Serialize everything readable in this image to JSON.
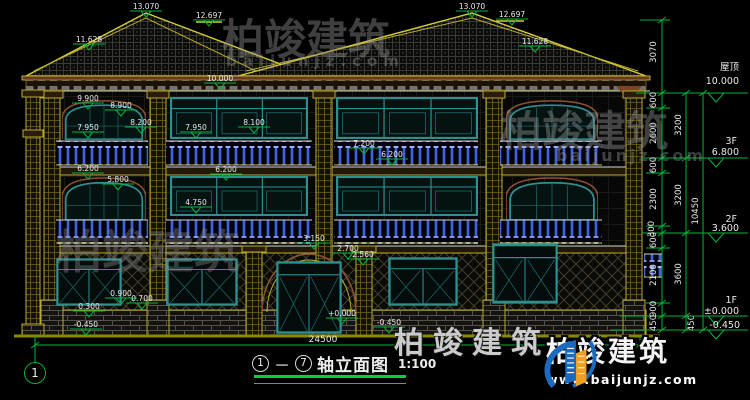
{
  "drawing": {
    "title": {
      "axis_start": "1",
      "axis_end": "7",
      "name": "轴立面图",
      "scale": "1:100"
    },
    "axis_bubble": "1",
    "total_width": "24500"
  },
  "markers": [
    {
      "label": "13.070"
    },
    {
      "label": "12.697"
    },
    {
      "label": "11.628"
    },
    {
      "label": "10.000"
    },
    {
      "label": "13.070"
    },
    {
      "label": "12.697"
    },
    {
      "label": "11.628"
    },
    {
      "label": "9.900"
    },
    {
      "label": "8.900"
    },
    {
      "label": "8.200"
    },
    {
      "label": "7.950"
    },
    {
      "label": "7.950"
    },
    {
      "label": "8.100"
    },
    {
      "label": "7.200"
    },
    {
      "label": "6.200"
    },
    {
      "label": "6.200"
    },
    {
      "label": "5.800"
    },
    {
      "label": "6.200"
    },
    {
      "label": "4.750"
    },
    {
      "label": "3.150"
    },
    {
      "label": "2.700"
    },
    {
      "label": "2.560"
    },
    {
      "label": "0.900"
    },
    {
      "label": "0.700"
    },
    {
      "label": "0.300"
    },
    {
      "label": "-0.450"
    },
    {
      "label": "+0.000"
    },
    {
      "label": "-0.450"
    }
  ],
  "levels": [
    {
      "name": "屋顶",
      "elev": "10.000"
    },
    {
      "name": "3F",
      "elev": "6.800"
    },
    {
      "name": "2F",
      "elev": "3.600"
    },
    {
      "name": "1F",
      "elev": "±0.000"
    },
    {
      "name": "",
      "elev": "-0.450"
    }
  ],
  "dims": {
    "top_segment": "3070",
    "chain_a": [
      "600",
      "2600",
      "600",
      "2300",
      "300",
      "600",
      "2100",
      "900",
      "450"
    ],
    "chain_b": [
      "3200",
      "3200",
      "3600",
      "450"
    ],
    "overall": "10450"
  },
  "watermark": {
    "brand": "柏竣建筑",
    "site": "baijunjz.com"
  },
  "branding": {
    "brand": "柏竣建筑",
    "url": "www.baijunjz.com"
  },
  "colors": {
    "bg": "#000000",
    "line_yellow": "#b8ae2e",
    "line_green": "#00b43c",
    "window_teal": "#2f8f8f",
    "baluster_blue": "#2e4ec4",
    "text": "#e8e8e8",
    "logo_blue": "#1a6ac0",
    "logo_orange": "#f0a020"
  }
}
